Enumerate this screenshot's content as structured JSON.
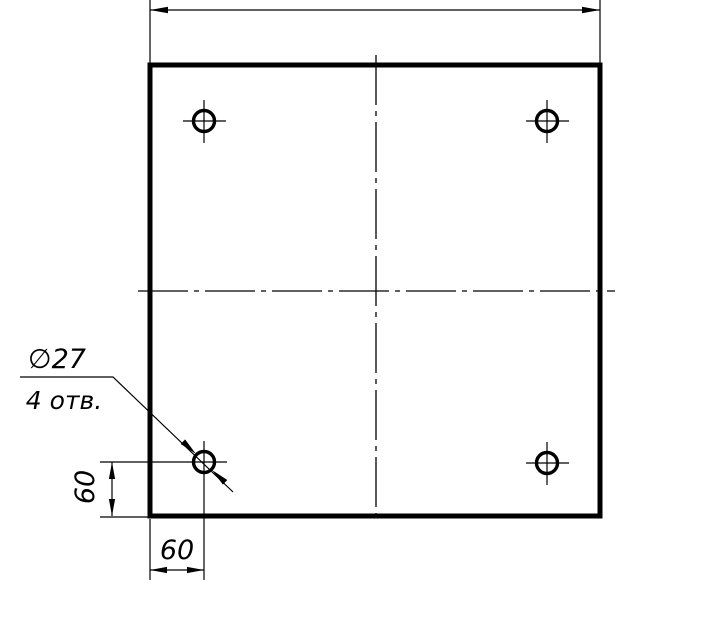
{
  "colors": {
    "background": "#ffffff",
    "ink": "#000000"
  },
  "callout": {
    "line1": "∅27",
    "line2": "4 отв."
  },
  "dimensions": {
    "vertical_offset": "60",
    "horizontal_offset": "60"
  }
}
